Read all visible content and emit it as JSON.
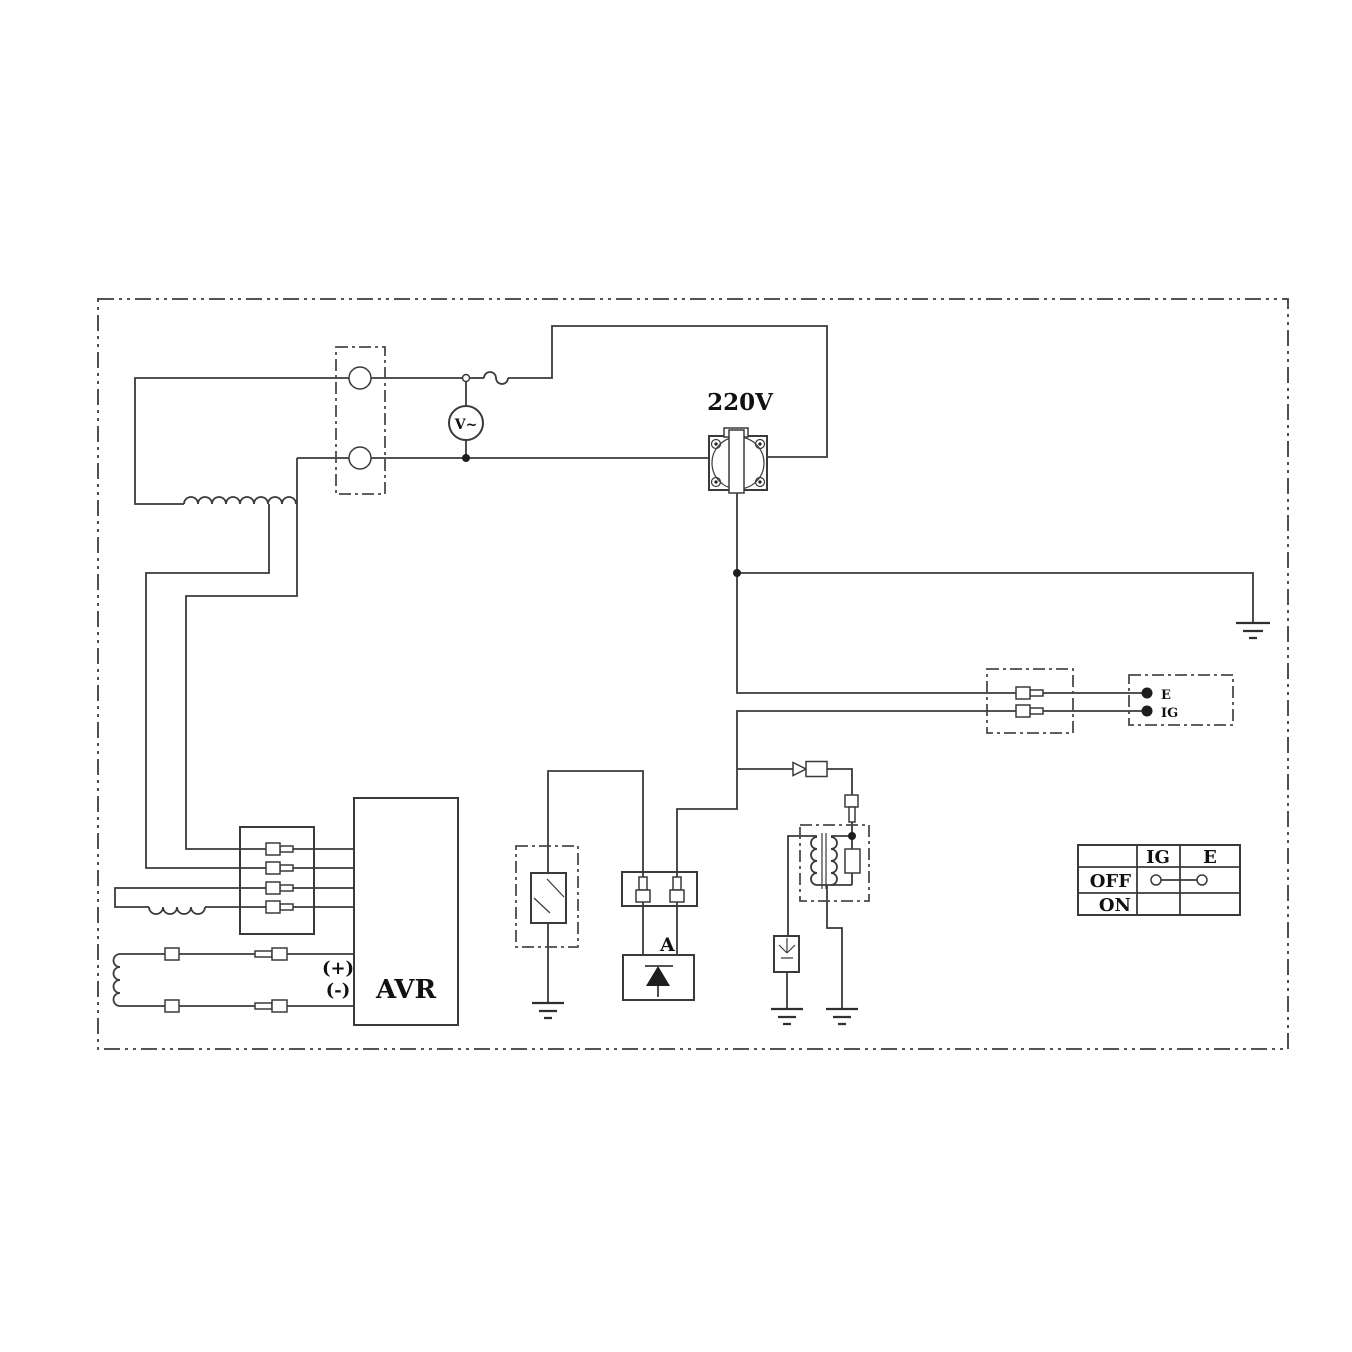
{
  "diagram": {
    "labels": {
      "voltage": "220V",
      "voltmeter": "V~",
      "avr": "AVR",
      "plus": "(+)",
      "minus": "(-)",
      "rectifier": "A",
      "terminal_e": "E",
      "terminal_ig": "IG"
    },
    "switch_table": {
      "col_headers": [
        "IG",
        "E"
      ],
      "rows": [
        {
          "label": "OFF",
          "ig_e_linked": true
        },
        {
          "label": "ON",
          "ig_e_linked": false
        }
      ]
    },
    "colors": {
      "line": "#3a3a3a",
      "text": "#111111",
      "background": "#ffffff"
    }
  }
}
